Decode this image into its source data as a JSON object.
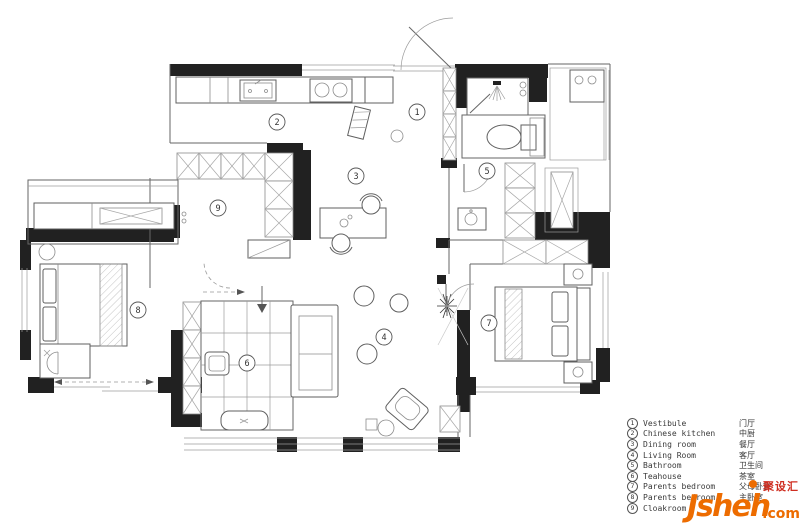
{
  "plan": {
    "labels": [
      {
        "num": "1"
      },
      {
        "num": "2"
      },
      {
        "num": "3"
      },
      {
        "num": "4"
      },
      {
        "num": "5"
      },
      {
        "num": "6"
      },
      {
        "num": "7"
      },
      {
        "num": "8"
      },
      {
        "num": "9"
      }
    ]
  },
  "legend": {
    "items": [
      {
        "num": "1",
        "en": "Vestibule",
        "cn": "门厅"
      },
      {
        "num": "2",
        "en": "Chinese kitchen",
        "cn": "中厨"
      },
      {
        "num": "3",
        "en": "Dining room",
        "cn": "餐厅"
      },
      {
        "num": "4",
        "en": "Living Room",
        "cn": "客厅"
      },
      {
        "num": "5",
        "en": "Bathroom",
        "cn": "卫生间"
      },
      {
        "num": "6",
        "en": "Teahouse",
        "cn": "茶室"
      },
      {
        "num": "7",
        "en": "Parents bedroom",
        "cn": "父母卧室"
      },
      {
        "num": "8",
        "en": "Parents bedroom",
        "cn": "主卧室"
      },
      {
        "num": "9",
        "en": "Cloakroom",
        "cn": ""
      }
    ]
  },
  "watermark": {
    "brand": "Jsheh",
    "tld": ".com",
    "cn": "聚设汇",
    "colors": {
      "orange": "#ed6c00",
      "red": "#cf2e21"
    }
  },
  "colors": {
    "wall": "#212121",
    "line": "#666666",
    "background": "#ffffff"
  }
}
